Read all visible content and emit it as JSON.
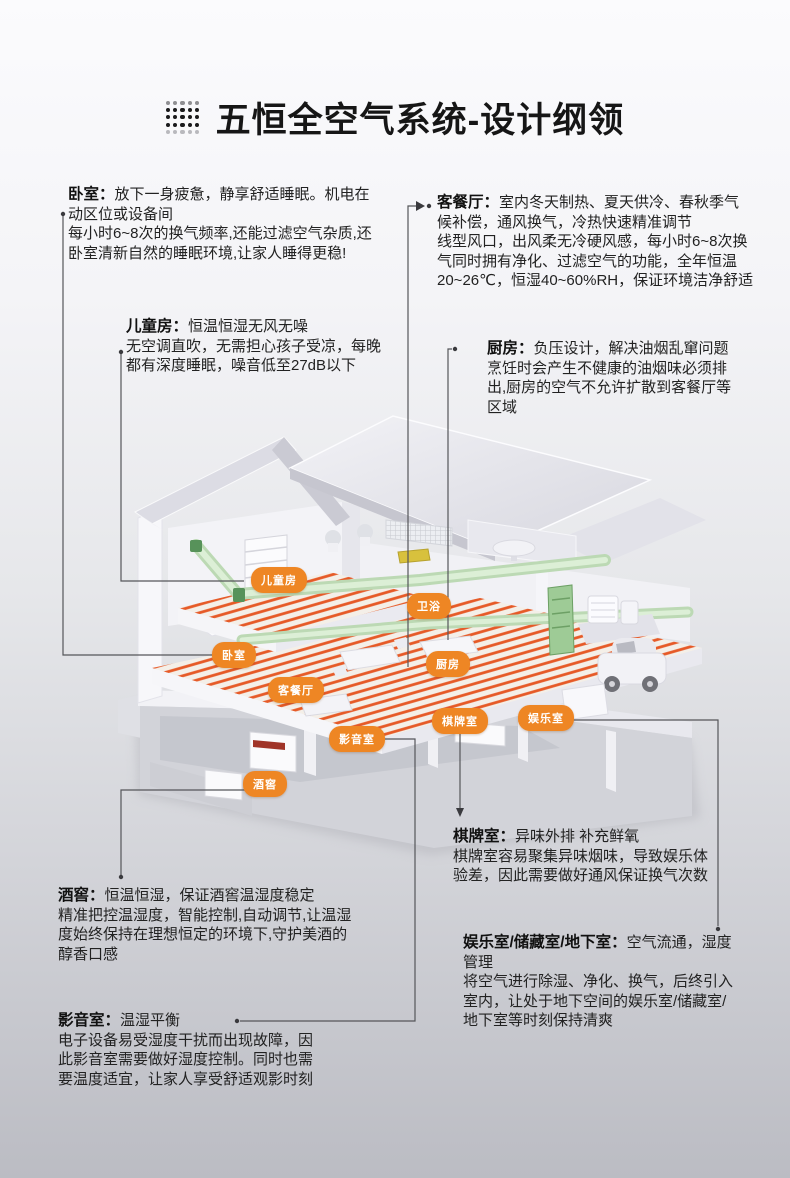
{
  "header": {
    "title": "五恒全空气系统-设计纲领",
    "icon": "dot-grid-icon"
  },
  "colors": {
    "accent": "#ee8624",
    "coil": "#e5521d",
    "duct_green": "#9ecb96",
    "connector": "#55565a",
    "title_text": "#161616",
    "body_text": "#222222"
  },
  "callouts": [
    {
      "id": "bedroom",
      "title": "卧室：",
      "text": "放下一身疲惫，静享舒适睡眠。机电在\n动区位或设备间\n每小时6~8次的换气频率,还能过滤空气杂质,还\n卧室清新自然的睡眠环境,让家人睡得更稳!"
    },
    {
      "id": "kids-room",
      "title": "儿童房：",
      "text": "恒温恒湿无风无噪\n无空调直吹，无需担心孩子受凉，每晚\n都有深度睡眠，噪音低至27dB以下"
    },
    {
      "id": "living-dining",
      "title": "客餐厅：",
      "text": "室内冬天制热、夏天供冷、春秋季气\n候补偿，通风换气，冷热快速精准调节\n线型风口，出风柔无冷硬风感，每小时6~8次换\n气同时拥有净化、过滤空气的功能，全年恒温\n20~26℃，恒湿40~60%RH，保证环境洁净舒适"
    },
    {
      "id": "kitchen",
      "title": "厨房：",
      "text": "负压设计，解决油烟乱窜问题\n烹饪时会产生不健康的油烟味必须排\n出,厨房的空气不允许扩散到客餐厅等\n区域"
    },
    {
      "id": "chess-room",
      "title": "棋牌室：",
      "text": "异味外排 补充鲜氧\n棋牌室容易聚集异味烟味，导致娱乐体\n验差，因此需要做好通风保证换气次数"
    },
    {
      "id": "wine-cellar",
      "title": "酒窖：",
      "text": "恒温恒湿，保证酒窖温湿度稳定\n精准把控温湿度，智能控制,自动调节,让温湿\n度始终保持在理想恒定的环境下,守护美酒的\n醇香口感"
    },
    {
      "id": "entertainment",
      "title": "娱乐室/储藏室/地下室：",
      "text": "空气流通，湿度\n管理\n将空气进行除湿、净化、换气，后终引入\n室内，让处于地下空间的娱乐室/储藏室/\n地下室等时刻保持清爽"
    },
    {
      "id": "home-theater",
      "title": "影音室：",
      "text": "温湿平衡\n电子设备易受湿度干扰而出现故障，因\n此影音室需要做好湿度控制。同时也需\n要温度适宜，让家人享受舒适观影时刻"
    }
  ],
  "house_labels": [
    {
      "text": "儿童房"
    },
    {
      "text": "卫浴"
    },
    {
      "text": "卧室"
    },
    {
      "text": "厨房"
    },
    {
      "text": "客餐厅"
    },
    {
      "text": "影音室"
    },
    {
      "text": "棋牌室"
    },
    {
      "text": "娱乐室"
    },
    {
      "text": "酒窖"
    }
  ]
}
